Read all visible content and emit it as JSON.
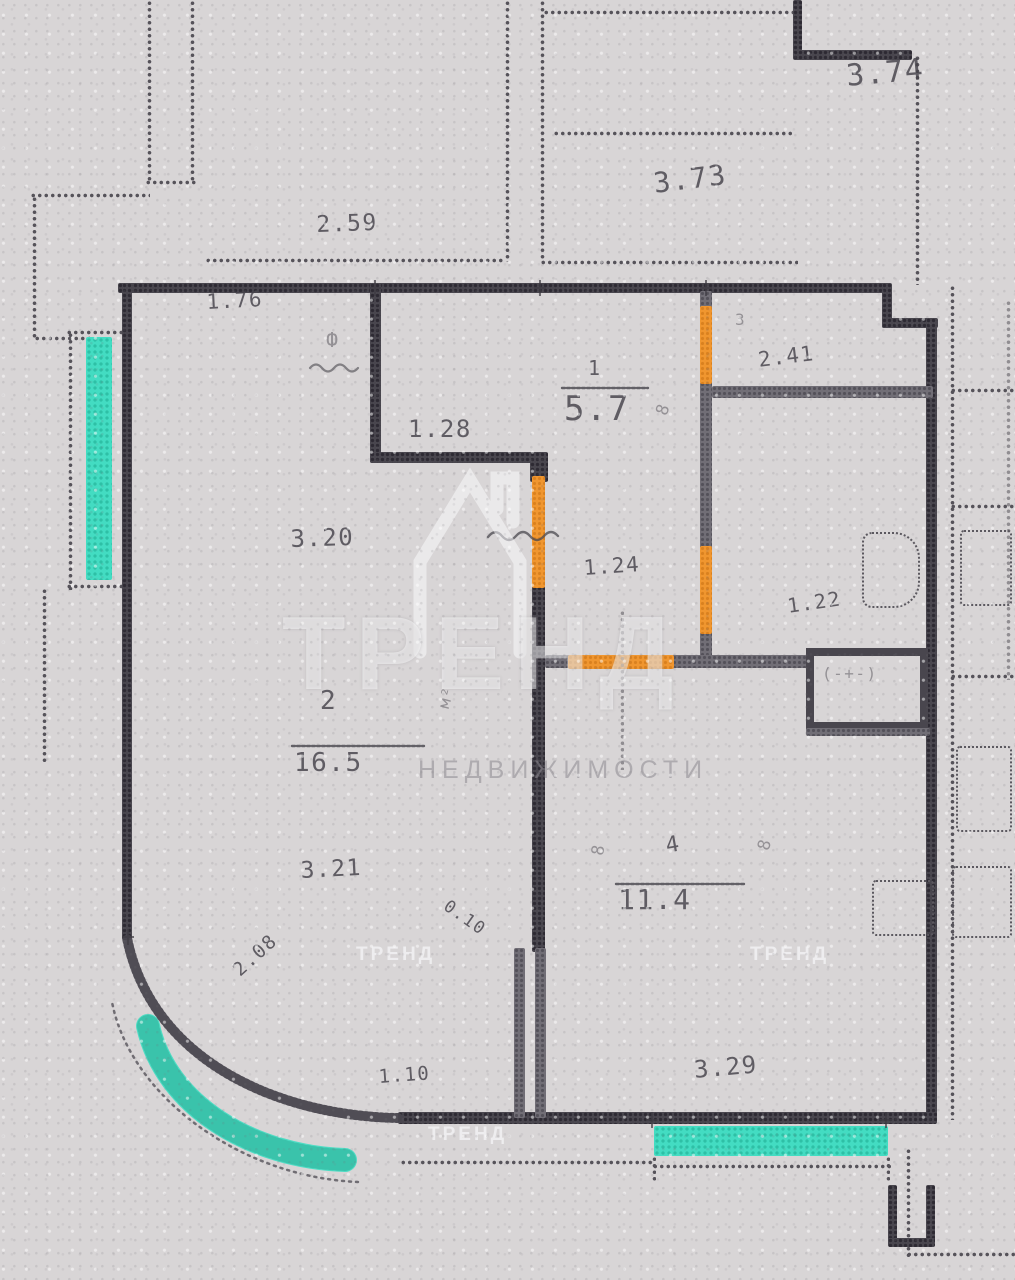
{
  "watermark": {
    "brand": "ТРЕНД",
    "caption": "НЕДВИЖИМОСТИ",
    "tiles": [
      {
        "n": "watermark-tile-1",
        "t": "ТРЕНД",
        "x": 356,
        "y": 944
      },
      {
        "n": "watermark-tile-2",
        "t": "ТРЕНД",
        "x": 750,
        "y": 944
      },
      {
        "n": "watermark-tile-3",
        "t": "ТРЕНД",
        "x": 428,
        "y": 1124
      }
    ]
  },
  "plan": {
    "colors": {
      "wall": "#49464e",
      "partition": "#716e76",
      "door_highlight": "#f0962f",
      "window_highlight": "#43dcc2",
      "paper": "#d8d5d6",
      "dots": "#56535a"
    },
    "walls": [
      {
        "n": "neighbor-pier-left-a",
        "c": "dv",
        "x": 147,
        "y": 0,
        "w": 5,
        "h": 183
      },
      {
        "n": "neighbor-pier-left-b",
        "c": "dv",
        "x": 190,
        "y": 0,
        "w": 5,
        "h": 183
      },
      {
        "n": "neighbor-pier-cap",
        "c": "dh",
        "x": 145,
        "y": 180,
        "w": 52,
        "h": 5
      },
      {
        "n": "neighbor-step-top",
        "c": "dh",
        "x": 30,
        "y": 193,
        "w": 120,
        "h": 5
      },
      {
        "n": "neighbor-step-side",
        "c": "dv",
        "x": 32,
        "y": 196,
        "w": 5,
        "h": 144
      },
      {
        "n": "bay-top-cap",
        "c": "dh",
        "x": 34,
        "y": 336,
        "w": 56,
        "h": 5
      },
      {
        "n": "bay-outer-edge",
        "c": "dv",
        "x": 68,
        "y": 332,
        "w": 5,
        "h": 258
      },
      {
        "n": "window-top-cap",
        "c": "dh",
        "x": 66,
        "y": 330,
        "w": 62,
        "h": 5
      },
      {
        "n": "window-bottom-cap",
        "c": "dh",
        "x": 66,
        "y": 584,
        "w": 62,
        "h": 5
      },
      {
        "n": "bay-lower-edge",
        "c": "dv",
        "x": 42,
        "y": 588,
        "w": 5,
        "h": 175
      },
      {
        "n": "neighbor-top-mid-left",
        "c": "dv",
        "x": 540,
        "y": 0,
        "w": 5,
        "h": 262
      },
      {
        "n": "neighbor-top-mid-right",
        "c": "dv",
        "x": 505,
        "y": 0,
        "w": 5,
        "h": 262
      },
      {
        "n": "neighbor-top-wall-a",
        "c": "dh",
        "x": 205,
        "y": 258,
        "w": 300,
        "h": 5
      },
      {
        "n": "neighbor-top-wall-b",
        "c": "dh",
        "x": 540,
        "y": 260,
        "w": 258,
        "h": 5
      },
      {
        "n": "neighbor-top-shelf",
        "c": "dh",
        "x": 553,
        "y": 131,
        "w": 240,
        "h": 5
      },
      {
        "n": "neighbor-top-edge",
        "c": "dh",
        "x": 543,
        "y": 10,
        "w": 252,
        "h": 5
      },
      {
        "n": "neighbor-corner-v",
        "c": "solid",
        "x": 793,
        "y": 0,
        "w": 9,
        "h": 58
      },
      {
        "n": "neighbor-corner-h",
        "c": "solid",
        "x": 793,
        "y": 50,
        "w": 119,
        "h": 10
      },
      {
        "n": "neighbor-right-dotted",
        "c": "dv",
        "x": 915,
        "y": 55,
        "w": 5,
        "h": 230
      },
      {
        "n": "unit-top-wall",
        "c": "solid",
        "x": 118,
        "y": 283,
        "w": 772,
        "h": 10
      },
      {
        "n": "unit-notch-v",
        "c": "solid",
        "x": 882,
        "y": 283,
        "w": 10,
        "h": 45
      },
      {
        "n": "unit-notch-h",
        "c": "solid",
        "x": 882,
        "y": 318,
        "w": 56,
        "h": 10
      },
      {
        "n": "unit-right-wall",
        "c": "solid",
        "x": 926,
        "y": 318,
        "w": 11,
        "h": 804
      },
      {
        "n": "unit-left-wall",
        "c": "solid",
        "x": 122,
        "y": 283,
        "w": 10,
        "h": 657
      },
      {
        "n": "unit-bottom-wall",
        "c": "solid",
        "x": 398,
        "y": 1112,
        "w": 539,
        "h": 12
      },
      {
        "n": "hall-wall-vertical",
        "c": "solid",
        "x": 370,
        "y": 283,
        "w": 11,
        "h": 180
      },
      {
        "n": "hall-wall-horizontal",
        "c": "solid",
        "x": 370,
        "y": 452,
        "w": 175,
        "h": 11
      },
      {
        "n": "hall-corner-block",
        "c": "solid",
        "x": 530,
        "y": 452,
        "w": 18,
        "h": 30
      },
      {
        "n": "living-bedroom-wall",
        "c": "solid",
        "x": 532,
        "y": 586,
        "w": 13,
        "h": 366
      },
      {
        "n": "duct-bar-left",
        "c": "gray",
        "x": 514,
        "y": 948,
        "w": 11,
        "h": 170
      },
      {
        "n": "duct-bar-right",
        "c": "gray",
        "x": 535,
        "y": 948,
        "w": 11,
        "h": 170
      },
      {
        "n": "wc-wall-stub-top",
        "c": "gray",
        "x": 700,
        "y": 291,
        "w": 12,
        "h": 20
      },
      {
        "n": "wc-wall-mid",
        "c": "gray",
        "x": 700,
        "y": 382,
        "w": 12,
        "h": 168
      },
      {
        "n": "wc-wall-low",
        "c": "gray",
        "x": 700,
        "y": 632,
        "w": 12,
        "h": 34
      },
      {
        "n": "bath-divider-wall",
        "c": "gray",
        "x": 712,
        "y": 386,
        "w": 221,
        "h": 12
      },
      {
        "n": "hall-bottom-stub",
        "c": "gray",
        "x": 545,
        "y": 655,
        "w": 27,
        "h": 13
      },
      {
        "n": "hall-bottom-right",
        "c": "gray",
        "x": 672,
        "y": 655,
        "w": 136,
        "h": 13
      },
      {
        "n": "vent-shaft",
        "c": "vent",
        "x": 806,
        "y": 648,
        "w": 122,
        "h": 82
      },
      {
        "n": "vent-shadow",
        "c": "gray",
        "x": 806,
        "y": 728,
        "w": 124,
        "h": 8
      },
      {
        "n": "door-wc-top",
        "c": "orange",
        "x": 700,
        "y": 306,
        "w": 12,
        "h": 78
      },
      {
        "n": "door-bath",
        "c": "orange",
        "x": 700,
        "y": 546,
        "w": 12,
        "h": 88
      },
      {
        "n": "door-living",
        "c": "orange",
        "x": 532,
        "y": 476,
        "w": 13,
        "h": 112
      },
      {
        "n": "door-bedroom",
        "c": "orange",
        "x": 568,
        "y": 655,
        "w": 106,
        "h": 14
      },
      {
        "n": "window-left",
        "c": "teal",
        "x": 86,
        "y": 337,
        "w": 26,
        "h": 243
      },
      {
        "n": "window-bottom",
        "c": "teal",
        "x": 654,
        "y": 1126,
        "w": 234,
        "h": 30
      },
      {
        "n": "balcony-edge-left",
        "c": "dh",
        "x": 400,
        "y": 1160,
        "w": 255,
        "h": 5
      },
      {
        "n": "window-bottom-frame",
        "c": "dh",
        "x": 652,
        "y": 1164,
        "w": 240,
        "h": 5
      },
      {
        "n": "window-frame-tick-l",
        "c": "dv",
        "x": 652,
        "y": 1156,
        "w": 4,
        "h": 26
      },
      {
        "n": "window-frame-tick-r",
        "c": "dv",
        "x": 886,
        "y": 1156,
        "w": 4,
        "h": 26
      },
      {
        "n": "neighbor-bottom-dotted-v",
        "c": "dv",
        "x": 906,
        "y": 1148,
        "w": 5,
        "h": 110
      },
      {
        "n": "neighbor-bottom-dotted-h",
        "c": "dh",
        "x": 906,
        "y": 1252,
        "w": 109,
        "h": 5
      },
      {
        "n": "neighbor-bottom-pier-a",
        "c": "solid",
        "x": 888,
        "y": 1185,
        "w": 9,
        "h": 60
      },
      {
        "n": "neighbor-bottom-pier-b",
        "c": "solid",
        "x": 926,
        "y": 1185,
        "w": 9,
        "h": 60
      },
      {
        "n": "neighbor-bottom-pier-c",
        "c": "solid",
        "x": 888,
        "y": 1238,
        "w": 47,
        "h": 9
      },
      {
        "n": "opening-dashed-line",
        "c": "dv faintline",
        "x": 620,
        "y": 610,
        "w": 4,
        "h": 160
      },
      {
        "n": "corridor-dotted-wall",
        "c": "dv",
        "x": 950,
        "y": 285,
        "w": 5,
        "h": 835
      },
      {
        "n": "right-room-line-1",
        "c": "dh",
        "x": 950,
        "y": 388,
        "w": 65,
        "h": 5
      },
      {
        "n": "right-room-line-2",
        "c": "dh",
        "x": 950,
        "y": 504,
        "w": 65,
        "h": 5
      },
      {
        "n": "right-room-line-3",
        "c": "dh",
        "x": 950,
        "y": 674,
        "w": 65,
        "h": 5
      },
      {
        "n": "right-edge-dotted",
        "c": "dv faintline",
        "x": 1006,
        "y": 300,
        "w": 5,
        "h": 380
      }
    ],
    "fixtures": [
      {
        "n": "toilet-fixture",
        "c": "dr toilet",
        "x": 862,
        "y": 532,
        "w": 58,
        "h": 76
      },
      {
        "n": "bedroom-cabinet",
        "c": "dr",
        "x": 872,
        "y": 880,
        "w": 62,
        "h": 56
      },
      {
        "n": "right-room-fixture-1",
        "c": "dr",
        "x": 960,
        "y": 530,
        "w": 52,
        "h": 76
      },
      {
        "n": "right-room-fixture-2",
        "c": "dr",
        "x": 956,
        "y": 746,
        "w": 56,
        "h": 86
      },
      {
        "n": "right-room-fixture-3",
        "c": "dr",
        "x": 952,
        "y": 866,
        "w": 60,
        "h": 72
      }
    ],
    "labels": [
      {
        "n": "dim-374",
        "t": "3.74",
        "x": 845,
        "y": 62,
        "fs": 30,
        "rot": -5
      },
      {
        "n": "dim-373",
        "t": "3.73",
        "x": 652,
        "y": 170,
        "fs": 28,
        "rot": -7
      },
      {
        "n": "dim-259",
        "t": "2.59",
        "x": 316,
        "y": 214,
        "fs": 23,
        "rot": -2
      },
      {
        "n": "dim-176",
        "t": "1.76",
        "x": 206,
        "y": 292,
        "fs": 21,
        "rot": -3
      },
      {
        "n": "riser-glyph",
        "t": "Ф",
        "x": 326,
        "y": 330,
        "fs": 20,
        "rot": 0,
        "cls": "faint"
      },
      {
        "n": "dim-128",
        "t": "1.28",
        "x": 408,
        "y": 417,
        "fs": 24,
        "rot": 0
      },
      {
        "n": "room-1-number",
        "t": "1",
        "x": 588,
        "y": 358,
        "fs": 20,
        "rot": 0
      },
      {
        "n": "room-1-area",
        "t": "5.7",
        "x": 564,
        "y": 392,
        "fs": 34,
        "rot": 0
      },
      {
        "n": "door-width-glyph",
        "t": "8",
        "x": 654,
        "y": 412,
        "fs": 17,
        "rot": -70,
        "cls": "faint"
      },
      {
        "n": "room-3-number",
        "t": "3",
        "x": 735,
        "y": 312,
        "fs": 16,
        "rot": 0,
        "cls": "faint"
      },
      {
        "n": "dim-241",
        "t": "2.41",
        "x": 757,
        "y": 350,
        "fs": 21,
        "rot": -7
      },
      {
        "n": "dim-124",
        "t": "1.24",
        "x": 583,
        "y": 558,
        "fs": 21,
        "rot": -4
      },
      {
        "n": "dim-122",
        "t": "1.22",
        "x": 786,
        "y": 596,
        "fs": 20,
        "rot": -8
      },
      {
        "n": "dim-320",
        "t": "3.20",
        "x": 290,
        "y": 527,
        "fs": 24,
        "rot": -2
      },
      {
        "n": "room-2-number",
        "t": "2",
        "x": 320,
        "y": 688,
        "fs": 26,
        "rot": 0
      },
      {
        "n": "room-2-area",
        "t": "16.5",
        "x": 294,
        "y": 750,
        "fs": 26,
        "rot": 0
      },
      {
        "n": "room-2-unit",
        "t": "м²",
        "x": 436,
        "y": 706,
        "fs": 16,
        "rot": -75,
        "cls": "faint"
      },
      {
        "n": "room-4-number",
        "t": "4",
        "x": 664,
        "y": 836,
        "fs": 22,
        "rot": -10
      },
      {
        "n": "room-4-area",
        "t": "11.4",
        "x": 618,
        "y": 886,
        "fs": 28,
        "rot": 0
      },
      {
        "n": "bedroom-glyph-left",
        "t": "8",
        "x": 590,
        "y": 854,
        "fs": 17,
        "rot": -80,
        "cls": "faint"
      },
      {
        "n": "bedroom-glyph-right",
        "t": "8",
        "x": 756,
        "y": 848,
        "fs": 17,
        "rot": -75,
        "cls": "faint"
      },
      {
        "n": "dim-321",
        "t": "3.21",
        "x": 300,
        "y": 860,
        "fs": 23,
        "rot": -3
      },
      {
        "n": "dim-010",
        "t": "0.10",
        "x": 450,
        "y": 898,
        "fs": 17,
        "rot": 35
      },
      {
        "n": "dim-208",
        "t": "2.08",
        "x": 230,
        "y": 966,
        "fs": 19,
        "rot": -42
      },
      {
        "n": "dim-110",
        "t": "1.10",
        "x": 378,
        "y": 1068,
        "fs": 19,
        "rot": -4
      },
      {
        "n": "dim-329",
        "t": "3.29",
        "x": 693,
        "y": 1058,
        "fs": 24,
        "rot": -5
      },
      {
        "n": "vent-shaft-marks",
        "t": "(-+-)",
        "x": 822,
        "y": 666,
        "fs": 16,
        "rot": 0,
        "cls": "faint"
      }
    ],
    "curves": [
      {
        "n": "curved-corner-wall",
        "d": "M398,1118 C 280,1116 152,1062 127,938",
        "stroke": "#49464e",
        "w": 10,
        "dash": "2 3.2",
        "op": 0.95
      },
      {
        "n": "curved-window",
        "d": "M345,1160 C 252,1157 166,1106 148,1026",
        "stroke": "#43dcc2",
        "w": 24,
        "dash": "",
        "op": 0.92
      },
      {
        "n": "curved-window-dots",
        "d": "M345,1160 C 252,1157 166,1106 148,1026",
        "stroke": "#14967e",
        "w": 22,
        "dash": "1.6 4.6",
        "op": 0.35
      },
      {
        "n": "outer-dotted-arc",
        "d": "M358,1182 C 240,1177 130,1096 112,1002",
        "stroke": "#56535a",
        "w": 2.5,
        "dash": "2 5",
        "op": 0.8
      },
      {
        "n": "room-1-underline",
        "d": "M562,388 L648,388",
        "stroke": "#45424a",
        "w": 2.4,
        "dash": "3 2",
        "op": 0.8
      },
      {
        "n": "room-2-underline",
        "d": "M292,746 L424,746",
        "stroke": "#45424a",
        "w": 2.4,
        "dash": "3 2",
        "op": 0.8
      },
      {
        "n": "room-4-underline",
        "d": "M616,884 L744,884",
        "stroke": "#45424a",
        "w": 2.4,
        "dash": "3 2",
        "op": 0.8
      },
      {
        "n": "dim-squiggle-hall",
        "d": "M488,537 q7,-9 14,-1 t14,0 t14,0 t14,0 t14,0",
        "stroke": "#4a474d",
        "w": 2.4,
        "dash": "",
        "op": 0.75
      },
      {
        "n": "dim-squiggle-riser",
        "d": "M310,368 q6,-7 12,0 t12,0 t12,0 t12,0",
        "stroke": "#4a474d",
        "w": 2.2,
        "dash": "",
        "op": 0.6
      },
      {
        "n": "watermark-house-icon",
        "d": "M420,652 L420,562 L470,480 L520,562 L520,652 M497,509 L497,478 L513,478 L513,522",
        "stroke": "rgba(252,252,254,0.7)",
        "w": 13,
        "dash": "",
        "op": 0.75
      }
    ],
    "ticks": [
      {
        "n": "tick-top-1",
        "x": 375,
        "y": 288
      },
      {
        "n": "tick-top-2",
        "x": 540,
        "y": 288
      },
      {
        "n": "tick-top-3",
        "x": 706,
        "y": 288
      },
      {
        "n": "tick-bottom-1",
        "x": 652,
        "y": 1120
      },
      {
        "n": "tick-bottom-2",
        "x": 886,
        "y": 1120
      },
      {
        "n": "tick-left-curve",
        "x": 128,
        "y": 937
      }
    ]
  }
}
